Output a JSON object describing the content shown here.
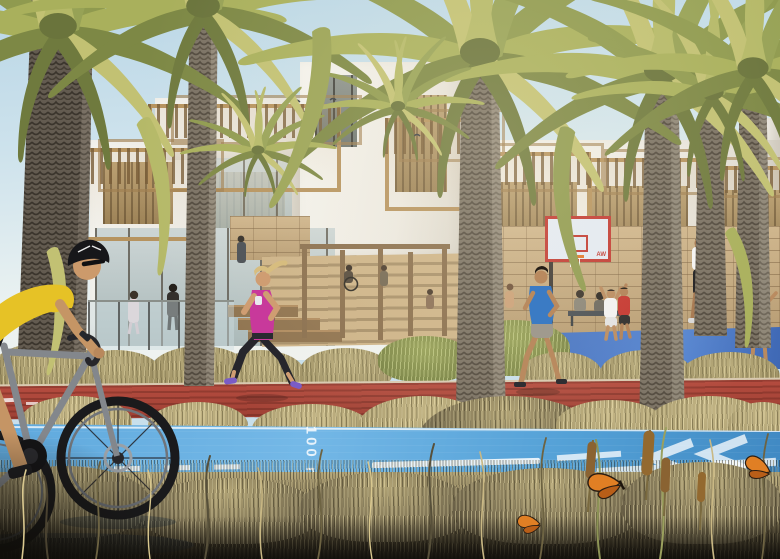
{
  "scene": {
    "description": "Sunlit architectural rendering: palm-lined promenade with white terraced houses and timber pergolas, stone walls, joggers on a red track, a cyclist on a blue cycle lane, basketball players, dry grasses and butterflies.",
    "lane_marking_label": "100 m",
    "jersey_number": "44",
    "backboard_logo": "AW"
  },
  "palette": {
    "sky": "#c8dfeb",
    "building_white": "#f0efe9",
    "timber": "#b6935f",
    "stone": "#c7ad84",
    "foliage_olive": "#9aa355",
    "dry_grass": "#b8ab7a",
    "track_red": "#b14a3e",
    "cycle_lane_blue": "#57a8de",
    "court_blue": "#4673c2",
    "cyclist_jersey_yellow": "#e6c226",
    "jogger_top_magenta": "#c8399b",
    "jogger_shirt_blue": "#3b7bc4",
    "butterfly_orange": "#e07f24"
  }
}
